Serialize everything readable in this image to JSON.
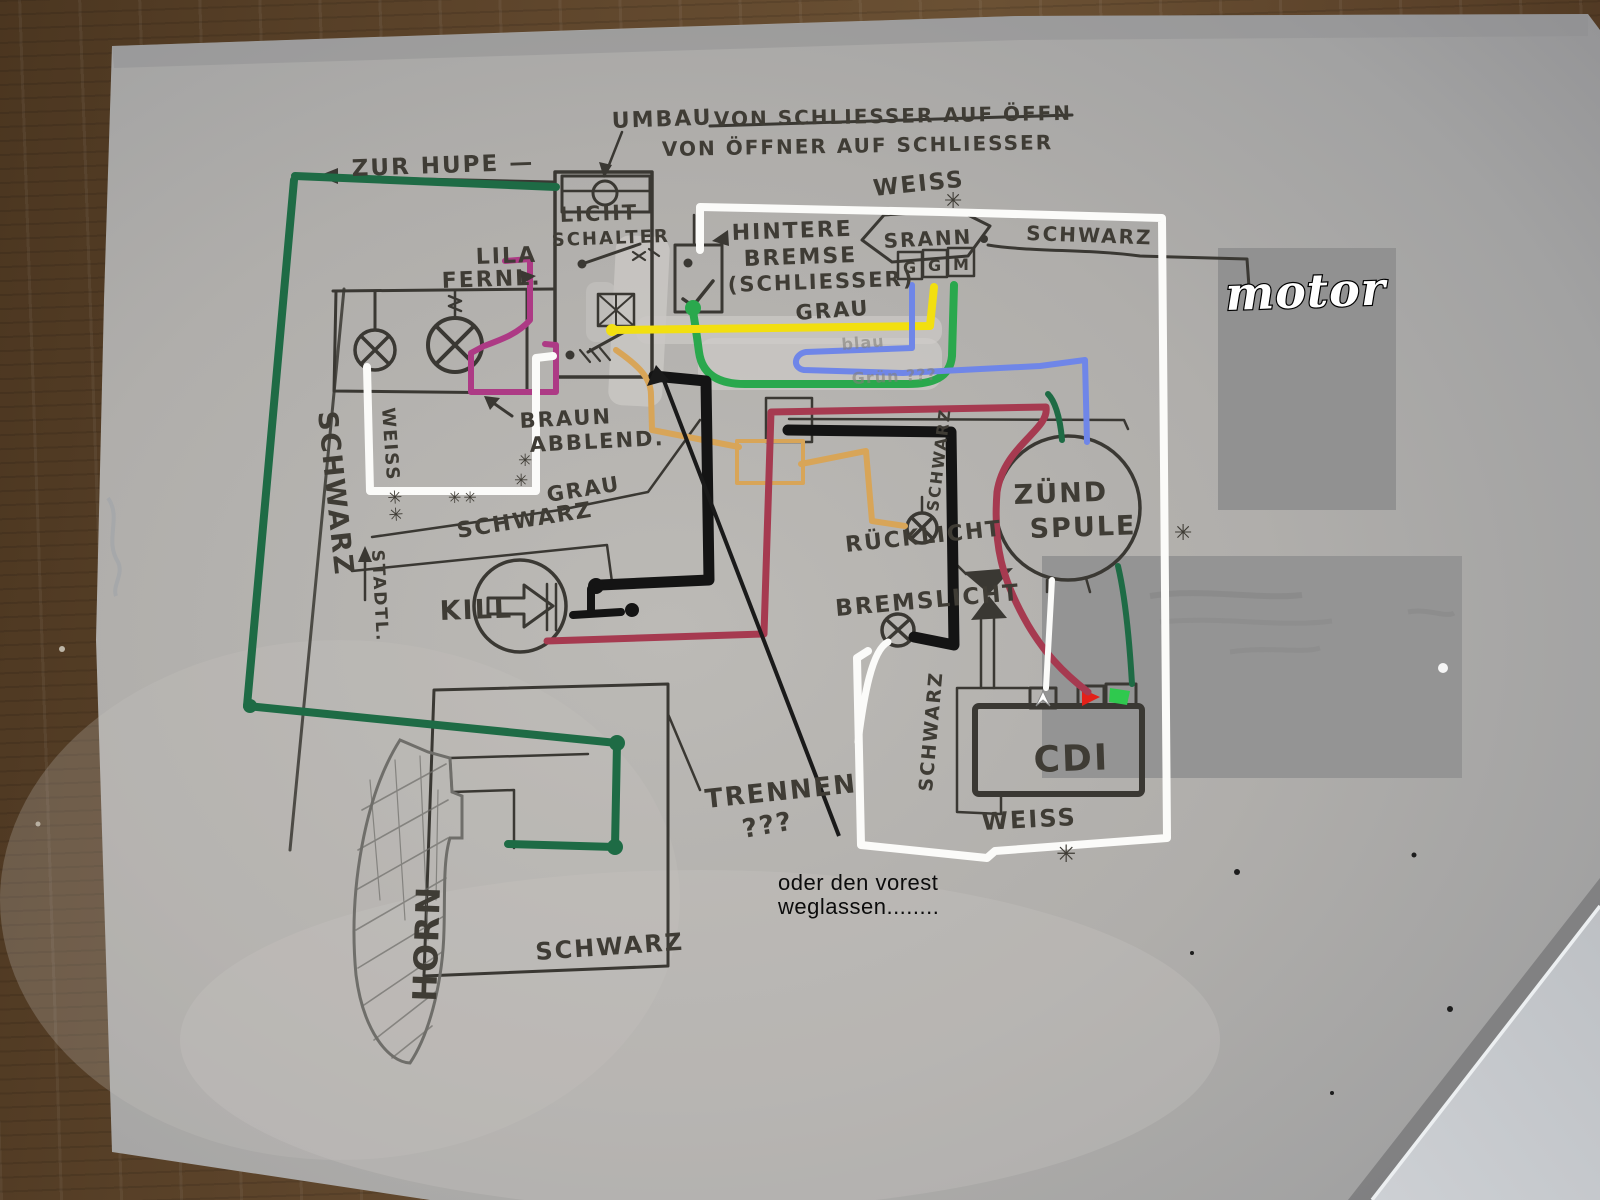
{
  "meta": {
    "description": "Photo of a hand-drawn German moped ignition/light wiring diagram on grey paper lying on a wooden table, with digital colour wire overlays and annotations"
  },
  "colors": {
    "wood": "#5f462c",
    "paper": "#b3b1ae",
    "pen": "#3a3833",
    "hand": "#3f3c35",
    "wire_green_dark": "#1e6b45",
    "wire_green": "#2aa84d",
    "wire_yellow": "#f2df10",
    "wire_blue": "#6f86e8",
    "wire_white": "#fbfbf9",
    "wire_red": "#a63a50",
    "wire_magenta": "#ad3a85",
    "wire_orange": "#d8a558",
    "wire_black": "#141414",
    "cdi_pin_red": "#e32119",
    "cdi_pin_green": "#2fc94e",
    "patch": "#8f8f8f"
  },
  "labels": {
    "umbau": "UMBAU",
    "umbau_struck": "VON SCHLIESSER AUF ÖFFN",
    "umbau_line2": "VON ÖFFNER AUF SCHLIESSER",
    "zur_hupe": "ZUR HUPE  —",
    "licht": "LICHT",
    "schalter": "SCHALTER",
    "lila": "LILA",
    "fernl": "FERNL.",
    "weiss_top": "WEISS",
    "ast_top": "✳",
    "srann": "SRANN",
    "pin_g1": "G",
    "pin_g2": "G",
    "pin_m": "M",
    "schwarz_top": "SCHWARZ",
    "motor": "motor",
    "hintere": "HINTERE",
    "bremse": "BREMSE",
    "schliesser": "(SCHLIESSER)",
    "grau_mid": "GRAU",
    "blau_faint": "blau",
    "gruen_faint": "Grün ???",
    "braun": "BRAUN",
    "abblend": "ABBLEND.",
    "ast_a": "✳",
    "ast_b": "✳",
    "ast_pair": "✳✳",
    "weiss_left": "WEISS ✳✳",
    "schwarz_left": "SCHWARZ",
    "stadtl": "STADTL.",
    "grau2": "GRAU",
    "schwarz2": "SCHWARZ",
    "kill": "KILL",
    "schwarz_rueck": "SCHWARZ",
    "ruecklicht": "RÜCKLICHT",
    "zuend": "ZÜND",
    "spule": "SPULE",
    "bremslicht": "BREMSLICHT",
    "schwarz_cdi": "SCHWARZ",
    "cdi": "CDI",
    "trennen": "TRENNEN",
    "fragezeichen": "???",
    "typed_line1": "oder den vorest",
    "typed_line2": "weglassen........",
    "weiss_bottom": "WEISS",
    "ast_bottom": "✳",
    "schwarz_bottom": "SCHWARZ",
    "horn": "HORN",
    "ast_right": "✳"
  }
}
